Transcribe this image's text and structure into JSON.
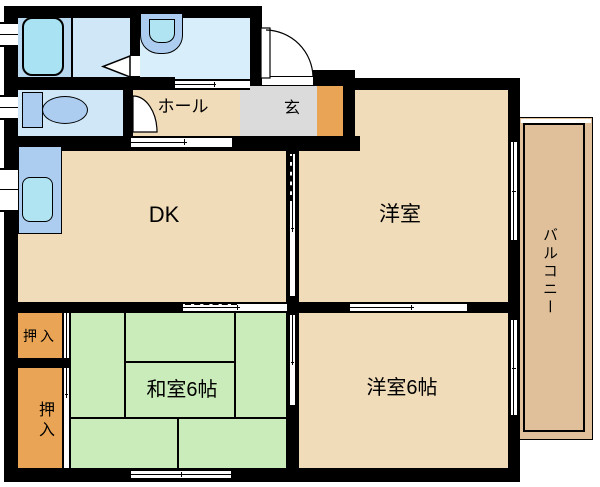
{
  "floorplan": {
    "rooms": {
      "dk": {
        "label": "DK"
      },
      "hall": {
        "label": "ホール"
      },
      "genkan": {
        "label": "玄"
      },
      "western_top": {
        "label": "洋室"
      },
      "japanese_room": {
        "label": "和室6帖"
      },
      "western_bottom": {
        "label": "洋室6帖"
      },
      "closet_top": {
        "label": "押入"
      },
      "closet_bottom": {
        "label": "押入"
      },
      "balcony": {
        "label": "バルコニー"
      }
    },
    "fixtures": {
      "bathtub": "bathtub",
      "washbasin": "washbasin",
      "toilet": "toilet",
      "kitchen_sink": "kitchen-sink"
    },
    "colors": {
      "wall": "#000000",
      "room_beige": "#f1dcba",
      "tatami_green": "#c9ecba",
      "closet_orange": "#e9a455",
      "genkan_gray": "#dbdbdb",
      "balcony_tan": "#dfc09a",
      "bath_blue": "#b9d9f1",
      "bath_blue_light": "#d0e7f8",
      "washroom_blue": "#d9eefb",
      "toilet_blue": "#d0e7f7",
      "fixture_blue": "#adcdf0",
      "tub_cyan": "#a9e2f2",
      "sink_cyan": "#b0e4f2"
    }
  }
}
